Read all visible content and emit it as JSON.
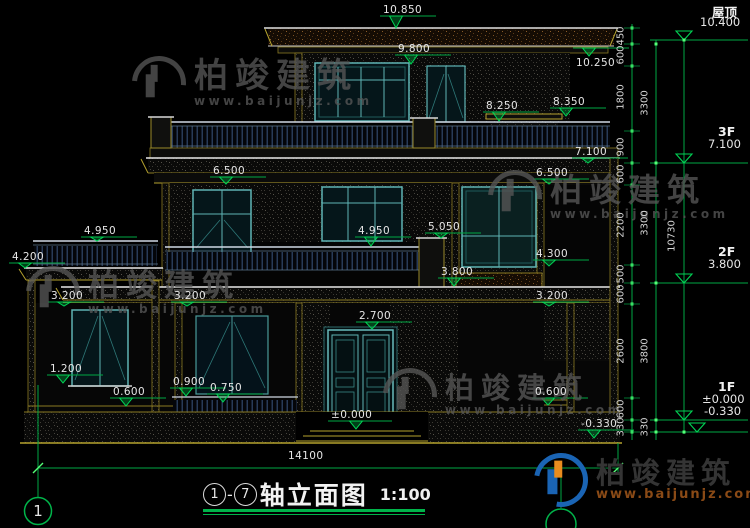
{
  "drawing": {
    "type": "building-elevation"
  },
  "title": {
    "axis_start": "1",
    "separator": "-",
    "axis_end": "7",
    "text": "轴立面图",
    "scale": "1:100"
  },
  "watermark": {
    "brand": "柏竣建筑",
    "url": "www.baijunjz.com"
  },
  "logo": {
    "brand": "柏竣建筑",
    "url": "www.baijunjz.com"
  },
  "axis_bubble": {
    "label": "1",
    "x": 38,
    "y": 511
  },
  "colors": {
    "dim_green": "#00a844",
    "tick_green": "#55ff77",
    "tri_green": "#00d455",
    "text": "#e6e6e6"
  },
  "right_levels": [
    {
      "name": "屋顶",
      "value": "10.400",
      "nx": 712,
      "ny": 2,
      "vx": 700,
      "vy": 15,
      "line_y": 40,
      "tri_x": 684
    },
    {
      "name": "3F",
      "value": "7.100",
      "nx": 718,
      "ny": 124,
      "vx": 708,
      "vy": 137,
      "line_y": 163,
      "tri_x": 684
    },
    {
      "name": "2F",
      "value": "3.800",
      "nx": 718,
      "ny": 244,
      "vx": 708,
      "vy": 257,
      "line_y": 283,
      "tri_x": 684
    },
    {
      "name": "1F",
      "value": "±0.000",
      "nx": 718,
      "ny": 379,
      "vx": 702,
      "vy": 392,
      "line_y": 420,
      "tri_x": 684
    },
    {
      "name": "",
      "value": "-0.330",
      "nx": 0,
      "ny": 0,
      "vx": 704,
      "vy": 404,
      "line_y": 432,
      "tri_x": 697
    }
  ],
  "facade_marks": [
    {
      "t": "10.850",
      "x": 383,
      "y": 4,
      "ly": 16,
      "ax": 396,
      "ay": 28
    },
    {
      "t": "9.800",
      "x": 398,
      "y": 43,
      "ly": 55,
      "ax": 411,
      "ay": 64
    },
    {
      "t": "10.250",
      "x": 576,
      "y": 57,
      "ly": 48,
      "ax": 589,
      "ay": 56
    },
    {
      "t": "8.250",
      "x": 486,
      "y": 100,
      "ly": 112,
      "ax": 499,
      "ay": 121
    },
    {
      "t": "8.350",
      "x": 553,
      "y": 96,
      "ly": 108,
      "ax": 566,
      "ay": 116
    },
    {
      "t": "7.100",
      "x": 575,
      "y": 146,
      "ly": 158,
      "ax": 588,
      "ay": 163
    },
    {
      "t": "6.500",
      "x": 213,
      "y": 165,
      "ly": 177,
      "ax": 226,
      "ay": 184
    },
    {
      "t": "6.500",
      "x": 536,
      "y": 167,
      "ly": 179,
      "ax": 549,
      "ay": 184
    },
    {
      "t": "4.950",
      "x": 84,
      "y": 225,
      "ly": 237,
      "ax": 97,
      "ay": 241
    },
    {
      "t": "4.950",
      "x": 358,
      "y": 225,
      "ly": 237,
      "ax": 371,
      "ay": 246
    },
    {
      "t": "5.050",
      "x": 428,
      "y": 221,
      "ly": 233,
      "ax": 441,
      "ay": 238
    },
    {
      "t": "4.200",
      "x": 12,
      "y": 251,
      "ly": 263,
      "ax": 25,
      "ay": 268
    },
    {
      "t": "4.300",
      "x": 536,
      "y": 248,
      "ly": 260,
      "ax": 549,
      "ay": 266
    },
    {
      "t": "3.800",
      "x": 441,
      "y": 266,
      "ly": 278,
      "ax": 454,
      "ay": 286
    },
    {
      "t": "3.200",
      "x": 51,
      "y": 290,
      "ly": 302,
      "ax": 64,
      "ay": 306
    },
    {
      "t": "3.200",
      "x": 174,
      "y": 290,
      "ly": 302,
      "ax": 187,
      "ay": 306
    },
    {
      "t": "3.200",
      "x": 536,
      "y": 290,
      "ly": 302,
      "ax": 549,
      "ay": 306
    },
    {
      "t": "2.700",
      "x": 359,
      "y": 310,
      "ly": 322,
      "ax": 372,
      "ay": 329
    },
    {
      "t": "1.200",
      "x": 50,
      "y": 363,
      "ly": 375,
      "ax": 63,
      "ay": 383
    },
    {
      "t": "0.900",
      "x": 173,
      "y": 376,
      "ly": 388,
      "ax": 186,
      "ay": 396
    },
    {
      "t": "0.750",
      "x": 210,
      "y": 382,
      "ly": 394,
      "ax": 223,
      "ay": 402
    },
    {
      "t": "0.600",
      "x": 113,
      "y": 386,
      "ly": 398,
      "ax": 126,
      "ay": 406
    },
    {
      "t": "0.600",
      "x": 535,
      "y": 386,
      "ly": 398,
      "ax": 548,
      "ay": 405
    },
    {
      "t": "±0.000",
      "x": 331,
      "y": 409,
      "ly": 421,
      "ax": 356,
      "ay": 429,
      "len": 64
    },
    {
      "t": "-0.330",
      "x": 581,
      "y": 418,
      "ly": 430,
      "ax": 594,
      "ay": 438
    }
  ],
  "right_dims": [
    {
      "t": "450",
      "x": 621,
      "y": 36
    },
    {
      "t": "600",
      "x": 621,
      "y": 55
    },
    {
      "t": "1800",
      "x": 621,
      "y": 97
    },
    {
      "t": "900",
      "x": 621,
      "y": 147
    },
    {
      "t": "600",
      "x": 621,
      "y": 174
    },
    {
      "t": "2200",
      "x": 621,
      "y": 225
    },
    {
      "t": "500",
      "x": 621,
      "y": 274
    },
    {
      "t": "600",
      "x": 621,
      "y": 294
    },
    {
      "t": "2600",
      "x": 621,
      "y": 351
    },
    {
      "t": "600",
      "x": 621,
      "y": 409
    },
    {
      "t": "330",
      "x": 621,
      "y": 427
    },
    {
      "t": "3300",
      "x": 645,
      "y": 103
    },
    {
      "t": "3300",
      "x": 645,
      "y": 223
    },
    {
      "t": "3800",
      "x": 645,
      "y": 351
    },
    {
      "t": "330",
      "x": 645,
      "y": 427
    },
    {
      "t": "10730",
      "x": 672,
      "y": 236
    }
  ],
  "bottom_dim": {
    "t": "14100",
    "x": 288,
    "y": 450
  }
}
